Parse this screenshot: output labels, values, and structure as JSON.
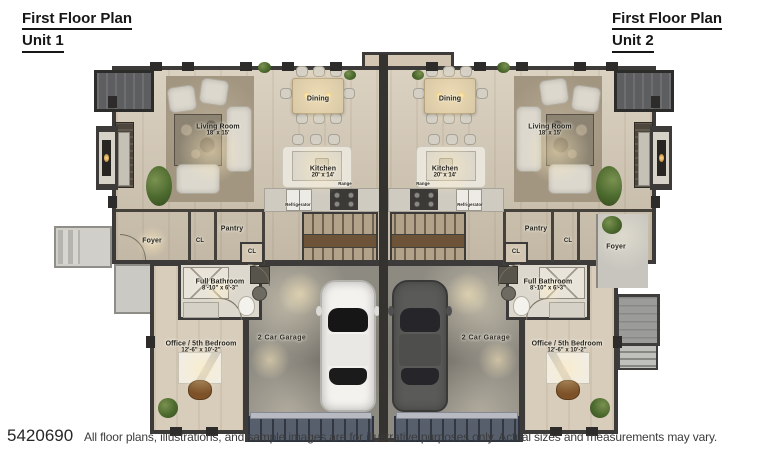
{
  "header": {
    "unit1": {
      "title": "First Floor Plan",
      "subtitle": "Unit 1"
    },
    "unit2": {
      "title": "First Floor Plan",
      "subtitle": "Unit 2"
    }
  },
  "footer": {
    "listing_id": "5420690",
    "disclaimer": "All floor plans, illustrations, and sample images are for illustrative purposes only. Actual sizes and measurements may vary."
  },
  "colors": {
    "wall": "#3c3b39",
    "wood_floor": "#d2c6b2",
    "living_carpet": "#a39681",
    "garage_concrete": "#8d8a82",
    "garage_door": "#4d5564"
  },
  "rooms": {
    "unit1": {
      "living_room": {
        "name": "Living Room",
        "dims": "18' x 15'"
      },
      "dining": {
        "name": "Dining"
      },
      "kitchen": {
        "name": "Kitchen",
        "dims": "20' x 14'"
      },
      "range": {
        "name": "Range"
      },
      "refrigerator": {
        "name": "Refrigerator"
      },
      "foyer": {
        "name": "Foyer"
      },
      "closet_a": {
        "name": "CL"
      },
      "pantry": {
        "name": "Pantry"
      },
      "closet_b": {
        "name": "CL"
      },
      "full_bathroom": {
        "name": "Full Bathroom",
        "dims": "8'-10\" x 6'-3\""
      },
      "office_bedroom": {
        "name": "Office / 5th Bedroom",
        "dims": "12'-6\" x 10'-2\""
      },
      "garage": {
        "name": "2 Car Garage"
      }
    },
    "unit2": {
      "living_room": {
        "name": "Living Room",
        "dims": "18' x 15'"
      },
      "dining": {
        "name": "Dining"
      },
      "kitchen": {
        "name": "Kitchen",
        "dims": "20' x 14'"
      },
      "range": {
        "name": "Range"
      },
      "refrigerator": {
        "name": "Refrigerator"
      },
      "foyer": {
        "name": "Foyer"
      },
      "closet_a": {
        "name": "CL"
      },
      "pantry": {
        "name": "Pantry"
      },
      "closet_b": {
        "name": "CL"
      },
      "full_bathroom": {
        "name": "Full Bathroom",
        "dims": "8'-10\" x 6'-3\""
      },
      "office_bedroom": {
        "name": "Office / 5th Bedroom",
        "dims": "12'-6\" x 10'-2\""
      },
      "garage": {
        "name": "2 Car Garage"
      }
    }
  }
}
